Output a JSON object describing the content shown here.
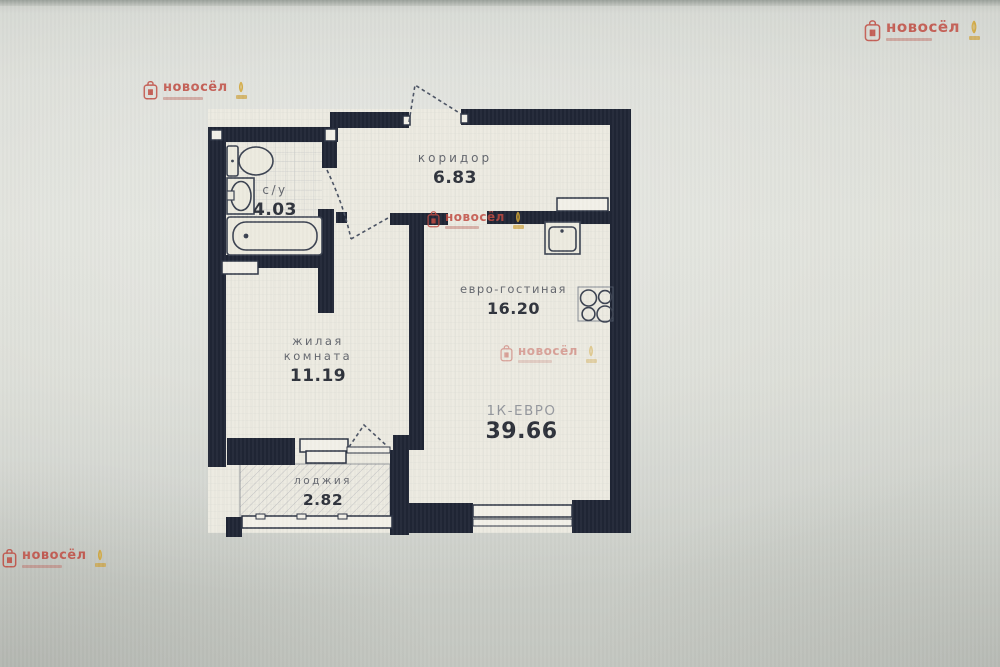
{
  "brand": {
    "name": "новосёл"
  },
  "apartment": {
    "type_label": "1К-ЕВРО",
    "total_area": "39.66"
  },
  "rooms": [
    {
      "id": "bathroom",
      "name": "с/у",
      "area": "4.03"
    },
    {
      "id": "corridor",
      "name": "коридор",
      "area": "6.83"
    },
    {
      "id": "living_room",
      "name_line1": "жилая",
      "name_line2": "комната",
      "area": "11.19"
    },
    {
      "id": "euro_living",
      "name": "евро-гостиная",
      "area": "16.20"
    },
    {
      "id": "loggia",
      "name": "лоджия",
      "area": "2.82"
    }
  ],
  "colors": {
    "wall": "#1f2535",
    "floor": "#eceae1",
    "brand_red": "#c04a40",
    "brand_gold": "#d2a431"
  }
}
